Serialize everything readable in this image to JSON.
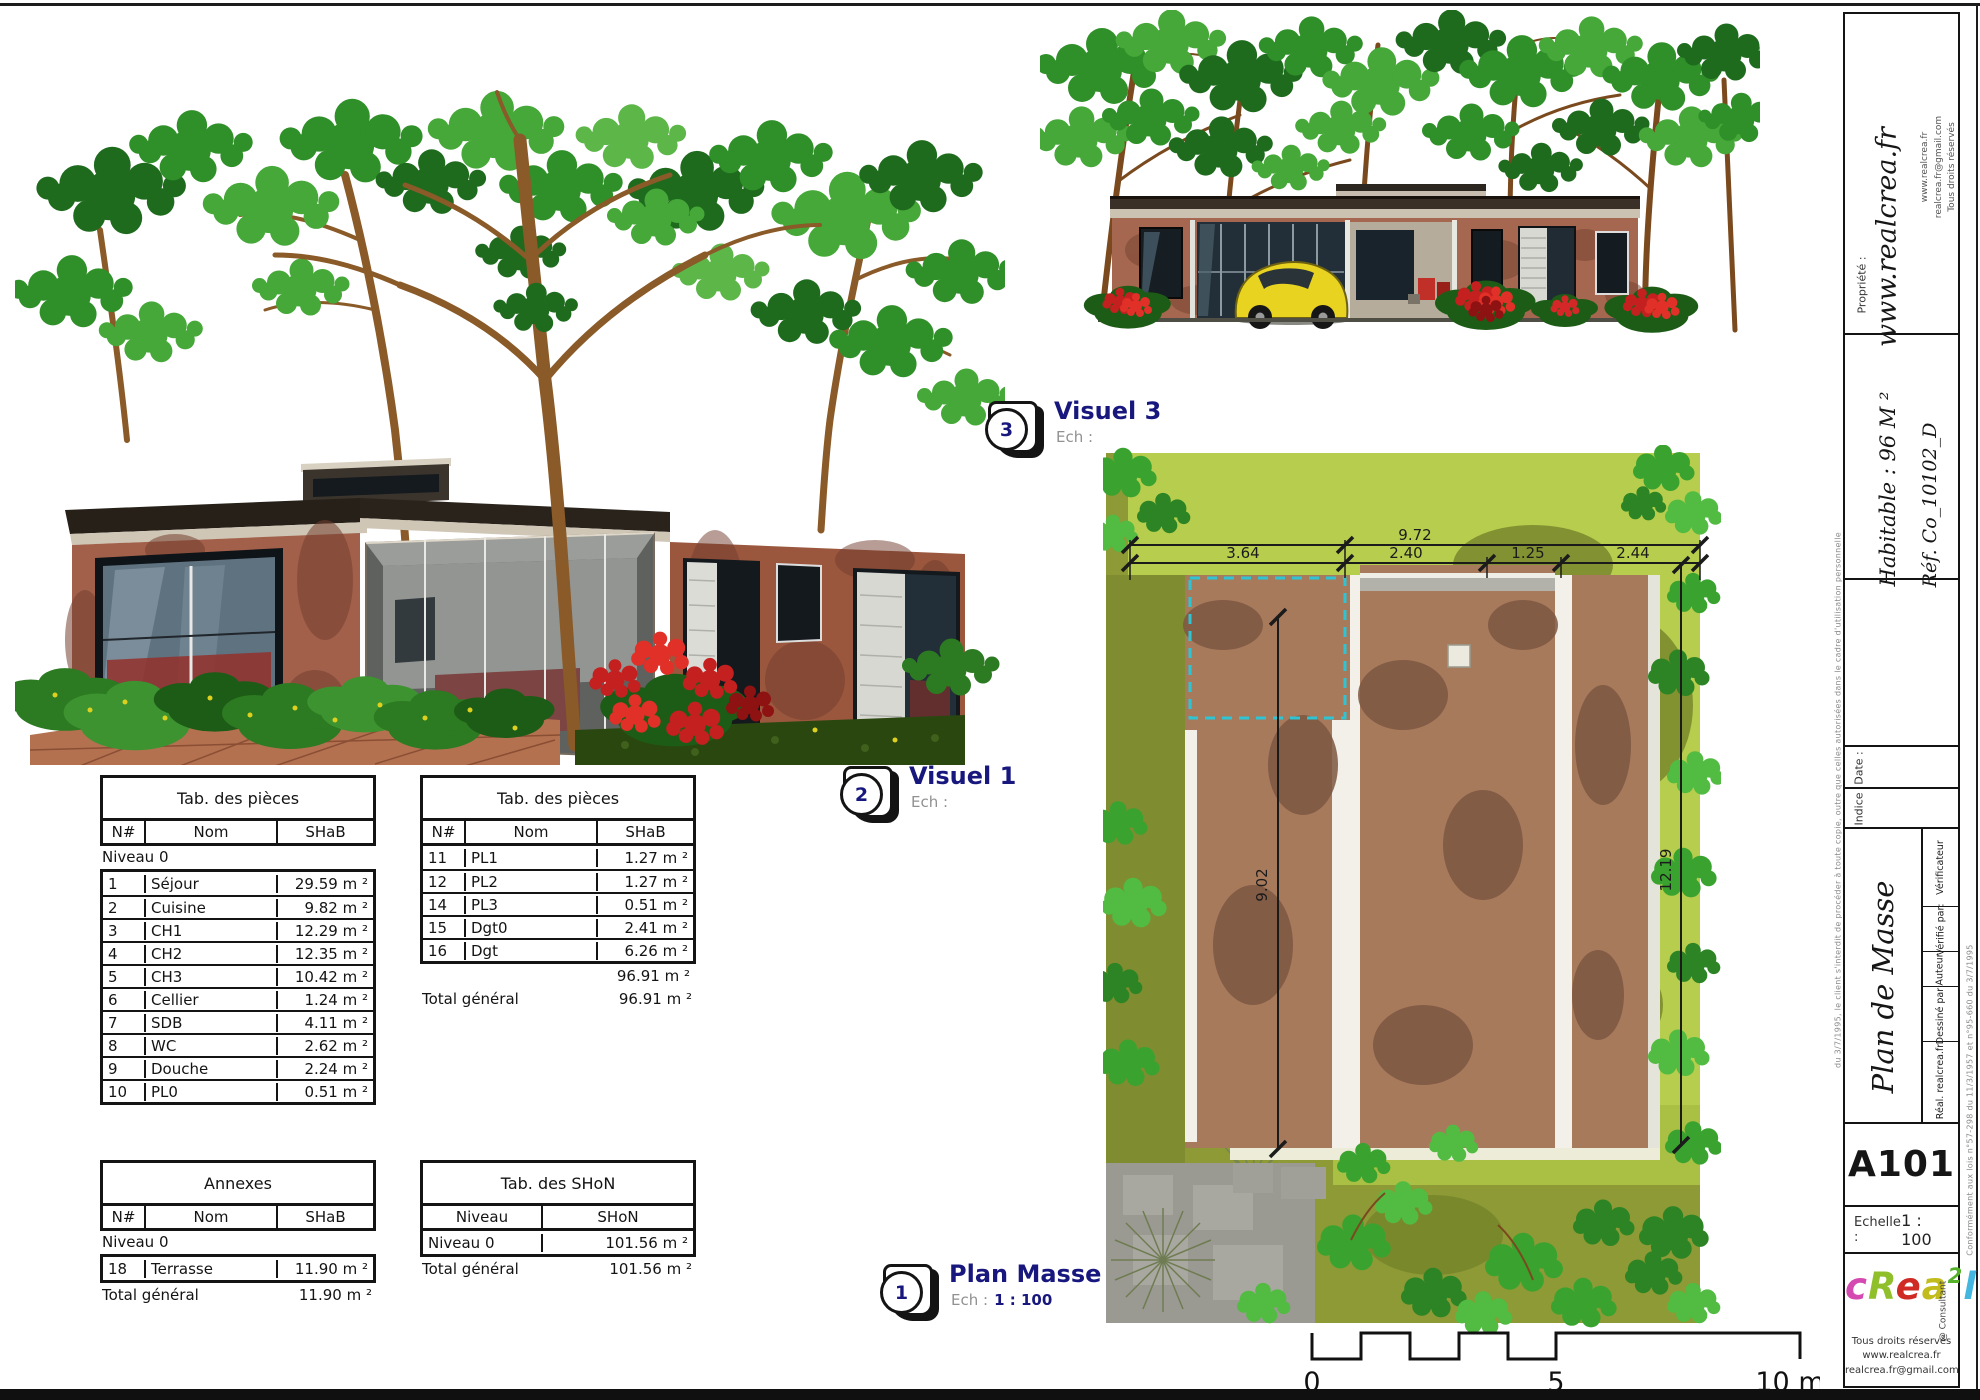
{
  "views": {
    "visuel3": {
      "badge": "3",
      "title": "Visuel 3",
      "ech_label": "Ech :",
      "ech_value": ""
    },
    "visuel1": {
      "badge": "2",
      "title": "Visuel 1",
      "ech_label": "Ech :",
      "ech_value": ""
    },
    "plan_masse": {
      "badge": "1",
      "title": "Plan Masse",
      "ech_label": "Ech :",
      "ech_value": "1 : 100"
    }
  },
  "tables": {
    "pieces_a": {
      "title": "Tab. des pièces",
      "headers": [
        "N#",
        "Nom",
        "SHaB"
      ],
      "section": "Niveau 0",
      "rows": [
        [
          "1",
          "Séjour",
          "29.59 m ²"
        ],
        [
          "2",
          "Cuisine",
          "9.82 m ²"
        ],
        [
          "3",
          "CH1",
          "12.29 m ²"
        ],
        [
          "4",
          "CH2",
          "12.35 m ²"
        ],
        [
          "5",
          "CH3",
          "10.42 m ²"
        ],
        [
          "6",
          "Cellier",
          "1.24 m ²"
        ],
        [
          "7",
          "SDB",
          "4.11 m ²"
        ],
        [
          "8",
          "WC",
          "2.62 m ²"
        ],
        [
          "9",
          "Douche",
          "2.24 m ²"
        ],
        [
          "10",
          "PL0",
          "0.51 m ²"
        ]
      ]
    },
    "pieces_b": {
      "title": "Tab. des pièces",
      "headers": [
        "N#",
        "Nom",
        "SHaB"
      ],
      "rows": [
        [
          "11",
          "PL1",
          "1.27 m ²"
        ],
        [
          "12",
          "PL2",
          "1.27 m ²"
        ],
        [
          "14",
          "PL3",
          "0.51 m ²"
        ],
        [
          "15",
          "Dgt0",
          "2.41 m ²"
        ],
        [
          "16",
          "Dgt",
          "6.26 m ²"
        ]
      ],
      "subtotal": "96.91 m ²",
      "total_label": "Total général",
      "total_value": "96.91 m ²"
    },
    "annexes": {
      "title": "Annexes",
      "headers": [
        "N#",
        "Nom",
        "SHaB"
      ],
      "section": "Niveau 0",
      "rows": [
        [
          "18",
          "Terrasse",
          "11.90 m ²"
        ]
      ],
      "total_label": "Total général",
      "total_value": "11.90 m ²"
    },
    "shon": {
      "title": "Tab. des SHoN",
      "headers": [
        "Niveau",
        "SHoN"
      ],
      "rows": [
        [
          "Niveau 0",
          "101.56 m ²"
        ]
      ],
      "total_label": "Total général",
      "total_value": "101.56 m ²"
    }
  },
  "plan": {
    "dims": {
      "total_width": "9.72",
      "seg1": "3.64",
      "seg2": "2.40",
      "seg3": "1.25",
      "seg4": "2.44",
      "left_height": "9.02",
      "right_height": "12.19"
    },
    "scalebar": {
      "t0": "0",
      "t5": "5",
      "t10": "10 m"
    }
  },
  "titleblock": {
    "propriete_label": "Propriété :",
    "propriete_value": "www.realcrea.fr",
    "contact_lines": [
      "www.realcrea.fr",
      "realcrea.fr@gmail.com",
      "Tous droits réservés"
    ],
    "habitable": "Habitable : 96 M ²",
    "reference": "Réf. Co_10102_D",
    "date_label": "Date :",
    "indice_label": "Indice",
    "sheet_title": "Plan de Masse",
    "verificateur": "Vérificateur",
    "verifie_par": "Vérifié par:",
    "auteur": "Auteur",
    "dessine_par": "Dessiné par:",
    "dessine_value": "Réal. realcrea.fr",
    "sheet_number": "A101",
    "echelle_label": "Echelle :",
    "echelle_value": "1 : 100",
    "logo_letters": [
      {
        "ch": "c",
        "color": "#d44ab0"
      },
      {
        "ch": "R",
        "color": "#8fbf2a"
      },
      {
        "ch": "e",
        "color": "#cf2b24"
      },
      {
        "ch": "a",
        "color": "#c2bb1c"
      },
      {
        "ch": "2",
        "color": "#55b02a",
        "sup": true
      },
      {
        "ch": "l",
        "color": "#43b7e0"
      }
    ],
    "consultant": "@ Consultant",
    "credits": [
      "Tous droits réservés",
      "www.realcrea.fr",
      "realcrea.fr@gmail.com"
    ],
    "legal_left": "du 3/7/1995, le client s'interdit de procéder à toute copie, outre que celles autorisées dans le cadre d'utilisation personnelle",
    "legal_right": "Conformément aux lois n°57-298 du 11/3/1957 et n°95-660 du 3/7/1995"
  }
}
